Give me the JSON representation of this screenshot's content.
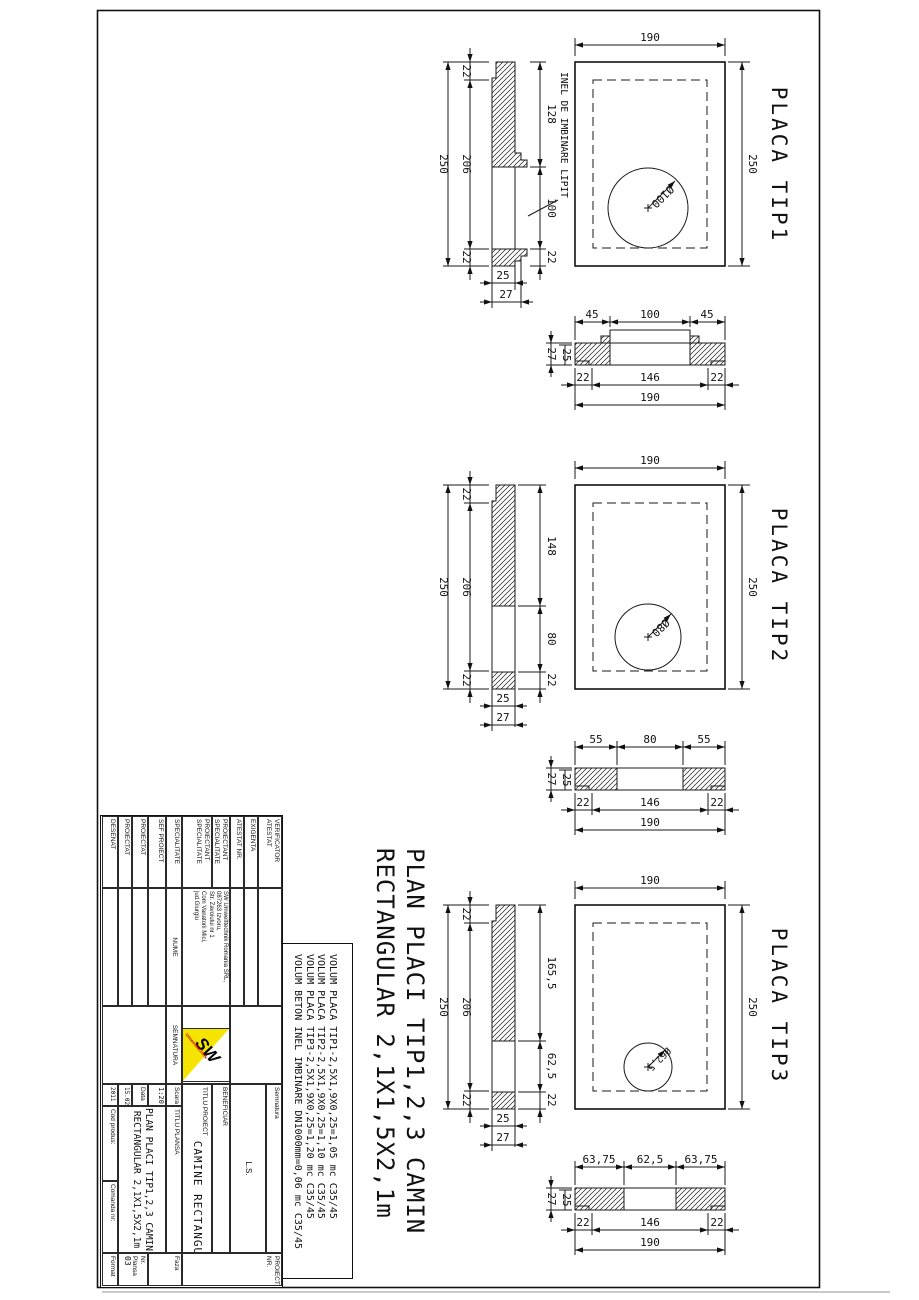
{
  "main_title": {
    "line1": "PLAN PLACI TIP1,2,3 CAMIN",
    "line2": "RECTANGULAR 2,1X1,5X2,1m"
  },
  "volume_notes": [
    "VOLUM PLACA TIP1-2,5X1,9X0,25=1,05 mc C35/45",
    "VOLUM PLACA TIP2-2,5X1,9X0,25=1,10 mc C35/45",
    "VOLUM PLACA TIP3-2,5X1,9X0,25=1,20 mc C35/45",
    "VOLUM BETON INEL IMBINARE DN1000mm=0,06 mc C35/45"
  ],
  "plates": [
    {
      "label": "PLACA TIP1",
      "plan": {
        "width": "190",
        "height": "250",
        "hole": "Ø100"
      },
      "side": {
        "total": "250",
        "inner": [
          "22",
          "206",
          "22"
        ],
        "right": [
          "128",
          "100",
          "22"
        ],
        "widths": [
          "25",
          "27"
        ],
        "note": "INEL DE IMBINARE LIPIT"
      },
      "section": {
        "top": [
          "45",
          "100",
          "45"
        ],
        "left": [
          "27",
          "25"
        ],
        "bottom": [
          "22",
          "146",
          "22"
        ],
        "total": "190"
      }
    },
    {
      "label": "PLACA TIP2",
      "plan": {
        "width": "190",
        "height": "250",
        "hole": "Ø80"
      },
      "side": {
        "total": "250",
        "inner": [
          "22",
          "206",
          "22"
        ],
        "right": [
          "148",
          "80",
          "22"
        ],
        "widths": [
          "25",
          "27"
        ]
      },
      "section": {
        "top": [
          "55",
          "80",
          "55"
        ],
        "left": [
          "27",
          "25"
        ],
        "bottom": [
          "22",
          "146",
          "22"
        ],
        "total": "190"
      }
    },
    {
      "label": "PLACA TIP3",
      "plan": {
        "width": "190",
        "height": "250",
        "hole": "Ø62,5"
      },
      "side": {
        "total": "250",
        "inner": [
          "22",
          "206",
          "22"
        ],
        "right": [
          "165,5",
          "62,5",
          "22"
        ],
        "widths": [
          "25",
          "27"
        ]
      },
      "section": {
        "top": [
          "63,75",
          "62,5",
          "63,75"
        ],
        "left": [
          "27",
          "25"
        ],
        "bottom": [
          "22",
          "146",
          "22"
        ],
        "total": "190"
      }
    }
  ],
  "title_block": {
    "verificator": "VERIFICATOR ATESTAT",
    "exigenta": "EXIGENTA",
    "atestat_nr": "ATESTAT NR.",
    "proiectant_1": "PROIECTANT SPECIALITATE",
    "proiectant_2": "PROIECTANT SPECIALITATE",
    "company": [
      "SW Umwelttechnik Romania SRL,",
      "087263 Izvoru,",
      "Str. Zavoiului nr 1",
      "Com Vanatorii Mici,",
      "jud.Giurgiu"
    ],
    "specialitate": "SPECIALITATE",
    "nume": "NUME",
    "semnatura_col": "SEMNATURA",
    "rows": [
      "SEF PROIECT",
      "PROIECTAT",
      "PROIECTAT",
      "DESENAT"
    ],
    "semnatura": "Semnatura",
    "ls": "L.S.",
    "beneficiar": "BENEFICIAR",
    "titlu_proiect_label": "TITLU PROIECT",
    "titlu_proiect": "CAMINE RECTANGULARE",
    "scara_label": "Scara",
    "scara": "1:20",
    "data_label": "Data",
    "data1": "15.02.",
    "data2": "2011",
    "titlu_plansa_label": "TITLU PLANSA",
    "plansa_line1": "PLAN PLACI TIP1,2,3 CAMIN",
    "plansa_line2": "RECTANGULAR 2,1X1,5X2,1m",
    "cod_produs": "Cod produs:",
    "comanda": "Comanda nr:",
    "format": "Format",
    "proiect_nr": "PROIECT NR.",
    "faza": "Faza",
    "nr_plansa": "Nr. Plansa",
    "nr_plansa_val": "03",
    "logo_sw": "SW",
    "logo_sub": "Umwelttechnik"
  }
}
